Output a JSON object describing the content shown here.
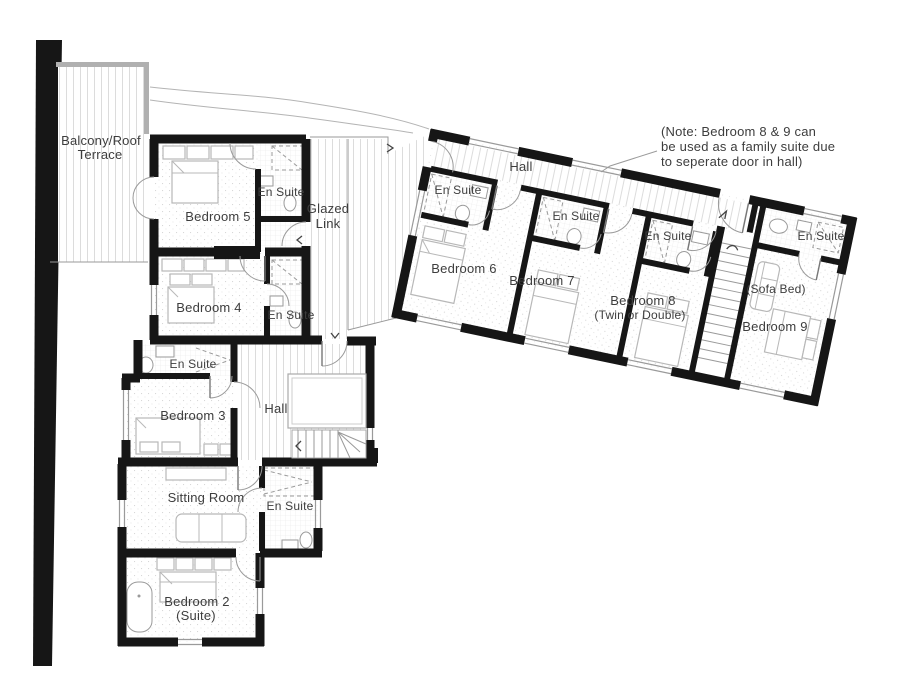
{
  "plan": {
    "labels": {
      "terrace_1": "Balcony/Roof",
      "terrace_2": "Terrace",
      "bedroom5": "Bedroom 5",
      "ensuite_b5": "En Suite",
      "glazed_1": "Glazed",
      "glazed_2": "Link",
      "bedroom4": "Bedroom 4",
      "ensuite_b4": "En Suite",
      "ensuite_b3": "En Suite",
      "bedroom3": "Bedroom 3",
      "hall_main": "Hall",
      "sitting": "Sitting Room",
      "ensuite_b2": "En Suite",
      "bedroom2_1": "Bedroom 2",
      "bedroom2_2": "(Suite)",
      "hall_wing": "Hall",
      "ensuite_b6": "En Suite",
      "bedroom6": "Bedroom 6",
      "ensuite_b7": "En Suite",
      "bedroom7": "Bedroom 7",
      "ensuite_b8": "En Suite",
      "bedroom8_1": "Bedroom 8",
      "bedroom8_2": "(Twin or Double)",
      "ensuite_b9": "En Suite",
      "sofa_bed": "(Sofa Bed)",
      "bedroom9": "Bedroom 9",
      "note_1": "(Note: Bedroom 8 & 9 can",
      "note_2": "be used as a family suite due",
      "note_3": "to seperate door in hall)"
    },
    "colors": {
      "wall": "#161616",
      "text": "#3d3d3d",
      "furniture_line": "#b8b8b8",
      "hatch_line": "#dcdcdc",
      "terrace_wall": "#b0b0b0",
      "background": "#ffffff"
    }
  }
}
